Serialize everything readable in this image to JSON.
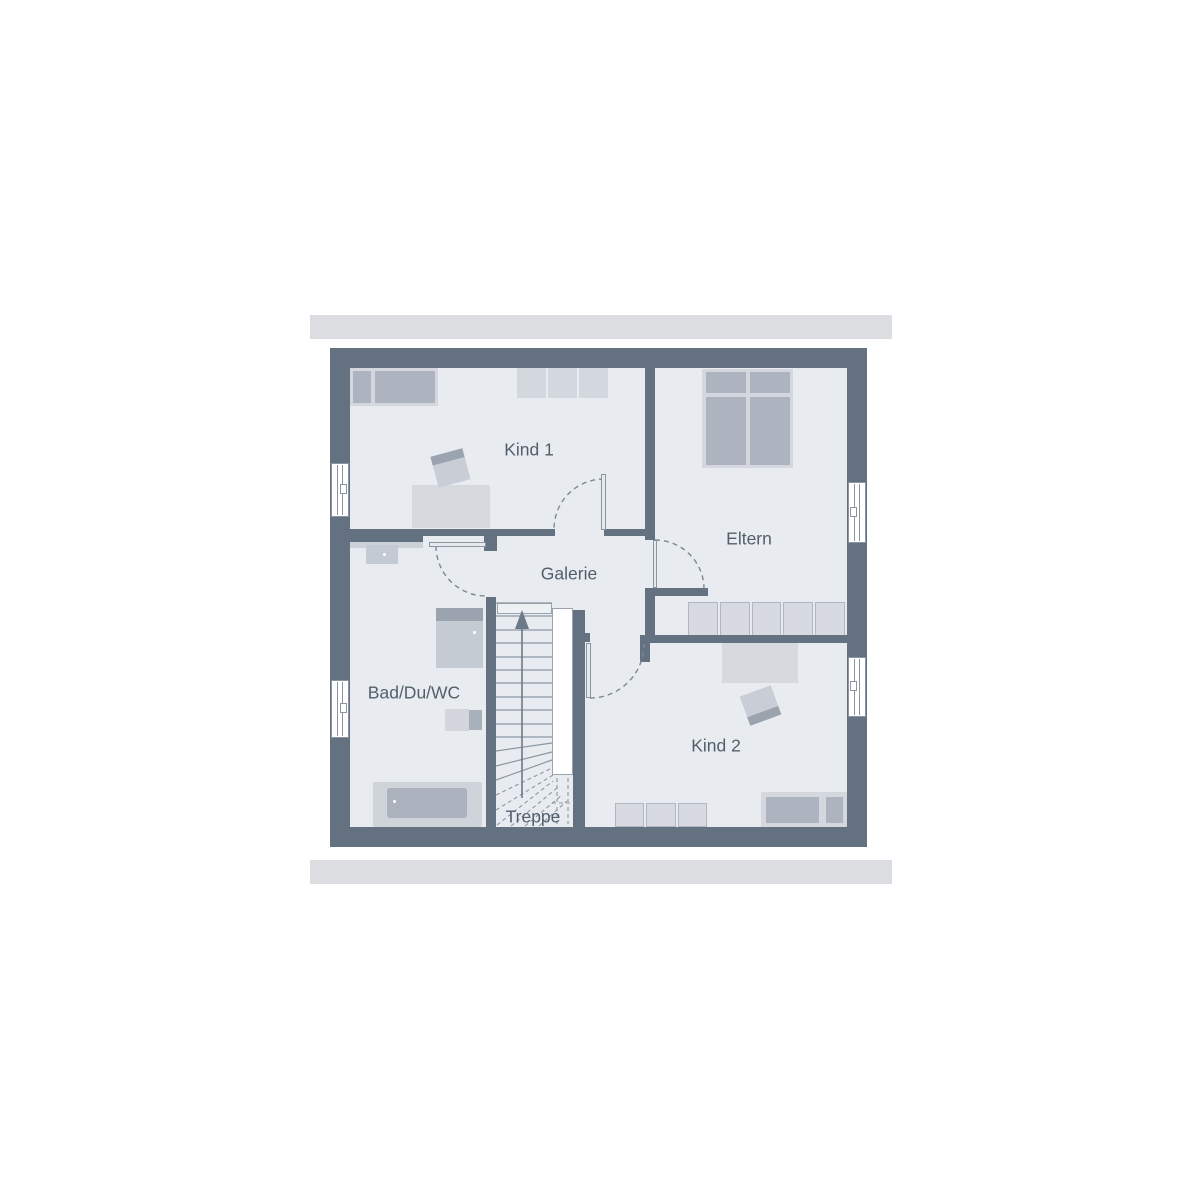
{
  "plan": {
    "title": "floor-plan-upper-storey",
    "rooms": [
      {
        "id": "kind1",
        "label": "Kind 1"
      },
      {
        "id": "eltern",
        "label": "Eltern"
      },
      {
        "id": "galerie",
        "label": "Galerie"
      },
      {
        "id": "bad",
        "label": "Bad/Du/WC"
      },
      {
        "id": "kind2",
        "label": "Kind 2"
      },
      {
        "id": "treppe",
        "label": "Treppe"
      }
    ],
    "colors": {
      "wall": "#647180",
      "floor": "#e8ecf0",
      "roof_band": "#dbdde1",
      "furniture_light": "#d4d8de",
      "furniture_medium": "#adb4bf",
      "furniture_dark": "#9aa3ae",
      "chair": "#c9ced6",
      "line": "#8a95a1",
      "stair_line": "#8d97a3",
      "arc": "#7d8896",
      "arrow": "#6b7988",
      "label_text": "#525f6b"
    }
  }
}
